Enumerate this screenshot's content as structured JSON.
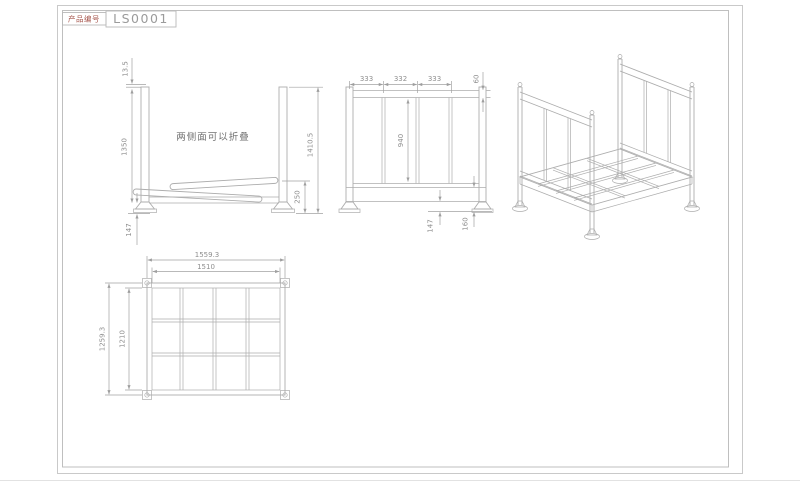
{
  "colors": {
    "line": "#adadad",
    "dimline": "#a2a2a2",
    "dim": "#8f8f8f",
    "frame": "#c9c9c9",
    "label": "#a5544b",
    "code": "#9b9b9b",
    "note": "#6f6f6f"
  },
  "title_block": {
    "label": "产品编号",
    "code": "LS0001"
  },
  "side_view": {
    "note": "两侧面可以折叠",
    "dims": {
      "top_offset": "13.5",
      "post_height": "1350",
      "total_height": "1410.5",
      "folded_height": "250",
      "foot_height": "147"
    }
  },
  "front_view": {
    "dims": {
      "bay1": "333",
      "bay2": "332",
      "bay3": "333",
      "rail": "60",
      "panel_height": "940",
      "clearance": "147",
      "base_height": "160"
    }
  },
  "plan_view": {
    "dims": {
      "outer_width": "1559.3",
      "inner_width": "1510",
      "outer_depth": "1259.3",
      "inner_depth": "1210"
    }
  }
}
